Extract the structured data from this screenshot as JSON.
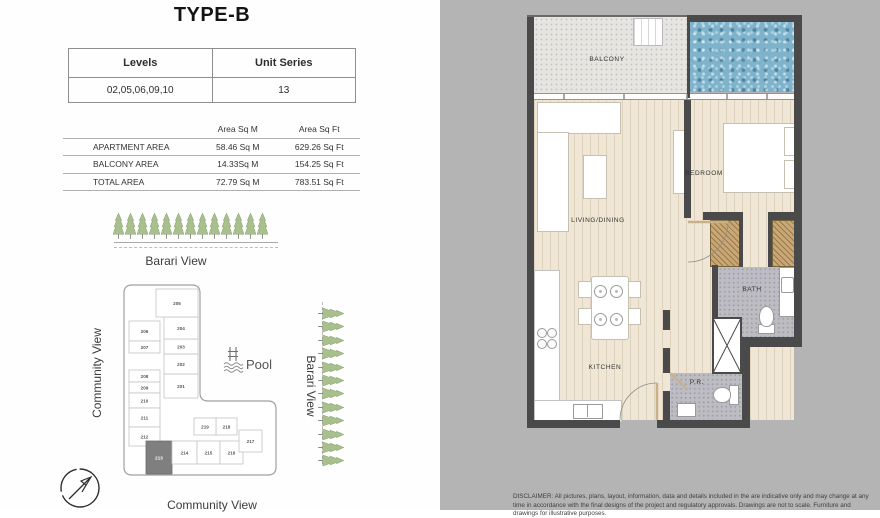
{
  "page_title": "TYPE-B",
  "levels_table": {
    "headers": [
      "Levels",
      "Unit Series"
    ],
    "row": [
      "02,05,06,09,10",
      "13"
    ]
  },
  "area_table": {
    "col_headers": [
      "Area Sq M",
      "Area Sq Ft"
    ],
    "rows": [
      {
        "label": "APARTMENT AREA",
        "sqm": "58.46 Sq M",
        "sqft": "629.26 Sq Ft"
      },
      {
        "label": "BALCONY AREA",
        "sqm": "14.33Sq M",
        "sqft": "154.25 Sq Ft"
      },
      {
        "label": "TOTAL AREA",
        "sqm": "72.79 Sq M",
        "sqft": "783.51 Sq Ft"
      }
    ]
  },
  "view_labels": {
    "top": "Barari View",
    "left": "Community View",
    "bottom": "Community View",
    "right": "Barari View"
  },
  "key_plan": {
    "pool_label": "Pool",
    "highlighted_unit": "213",
    "units": [
      "201",
      "202",
      "203",
      "204",
      "205",
      "206",
      "207",
      "208",
      "209",
      "210",
      "211",
      "212",
      "213",
      "214",
      "215",
      "216",
      "217",
      "218",
      "219"
    ]
  },
  "floor_plan": {
    "rooms": {
      "balcony": "BALCONY",
      "living_dining": "LIVING/DINING",
      "bedroom": "BEDROOM",
      "kitchen": "KITCHEN",
      "bath": "BATH",
      "powder_room": "P.R."
    }
  },
  "disclaimer": "DISCLAIMER: All pictures, plans, layout, information, data and details included in the are indicative only and may change at any time in accordance with the final designs of the project and regulatory approvals. Drawings are not to scale. Furniture and drawings for illustrative purposes.",
  "colors": {
    "wall": "#4a4a4a",
    "floor_wood": "#efe6d5",
    "pool_water": "#7fb3cc",
    "tile": "#bcbcc2",
    "wardrobe": "#c9a876",
    "keyplan_highlight": "#7f7f7f"
  }
}
